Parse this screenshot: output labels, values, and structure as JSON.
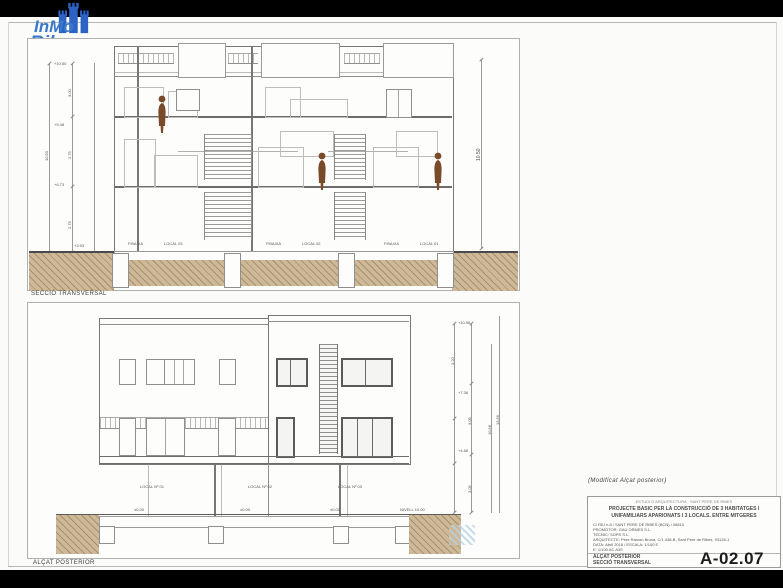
{
  "logo": {
    "line1": "InMo",
    "line2": "Ribes",
    "color": "#3a79cc"
  },
  "top_drawing": {
    "caption": "SECCIÓ TRANSVERSAL",
    "units": [
      {
        "level_label": "P.BAIXA",
        "name": "LOCAL 03"
      },
      {
        "level_label": "P.BAIXA",
        "name": "LOCAL 02"
      },
      {
        "level_label": "P.BAIXA",
        "name": "LOCAL 01"
      }
    ],
    "dims": {
      "overall_left": "10.50",
      "overall_right": "10.50",
      "left_levels": [
        "+10.50",
        "+9.48",
        "+6.73",
        "+3.93"
      ],
      "left_segments": [
        "3.00",
        "2.75",
        "2.75"
      ]
    }
  },
  "bottom_drawing": {
    "caption": "ALÇAT POSTERIOR",
    "locals": [
      {
        "name": "LOCAL Nº 01",
        "level": "±0.00"
      },
      {
        "name": "LOCAL Nº 02",
        "level": "±0.00"
      },
      {
        "name": "LOCAL Nº 03",
        "level": "±0.00"
      }
    ],
    "grade_label": "NIVELL ±0.00",
    "dims": {
      "right_levels": [
        "+10.56",
        "+7.36",
        "+4.56"
      ],
      "right_segments": [
        "3.20",
        "3.05",
        "3.05"
      ],
      "overall": "10.56",
      "total": "13.56"
    }
  },
  "title_block": {
    "note": "(Modificat Alçat posterior)",
    "header": "ESTUDI D'ARQUITECTURA · SANT PERE DE RIBES",
    "project_line1": "PROJECTE BASIC PER LA CONSTRUCCIÓ DE 3 HABITATGES I",
    "project_line2": "UNIFAMILIARS APARIONATS I 3 LOCALS. ENTRE MITGERES",
    "info_lines": [
      "C/ RIU n.8 / SANT PERE DE RIBES (BCN) / 08810",
      "PROMOTOR: GAU ORMES S.L.",
      "TECNIC: SOPS S.L.",
      "ARQUITECTE: Pere Ramon Bruna, C/1.438-B, Sant Pere de Ribes, 93128-1",
      "DATA: Abril 2018 / ESCALA: 1/100 E",
      "E:   1/100 AC A3S"
    ],
    "sheet_title_1": "ALÇAT POSTERIOR",
    "sheet_title_2": "SECCIÓ TRANSVERSAL",
    "sheet_number": "A-02.07"
  }
}
